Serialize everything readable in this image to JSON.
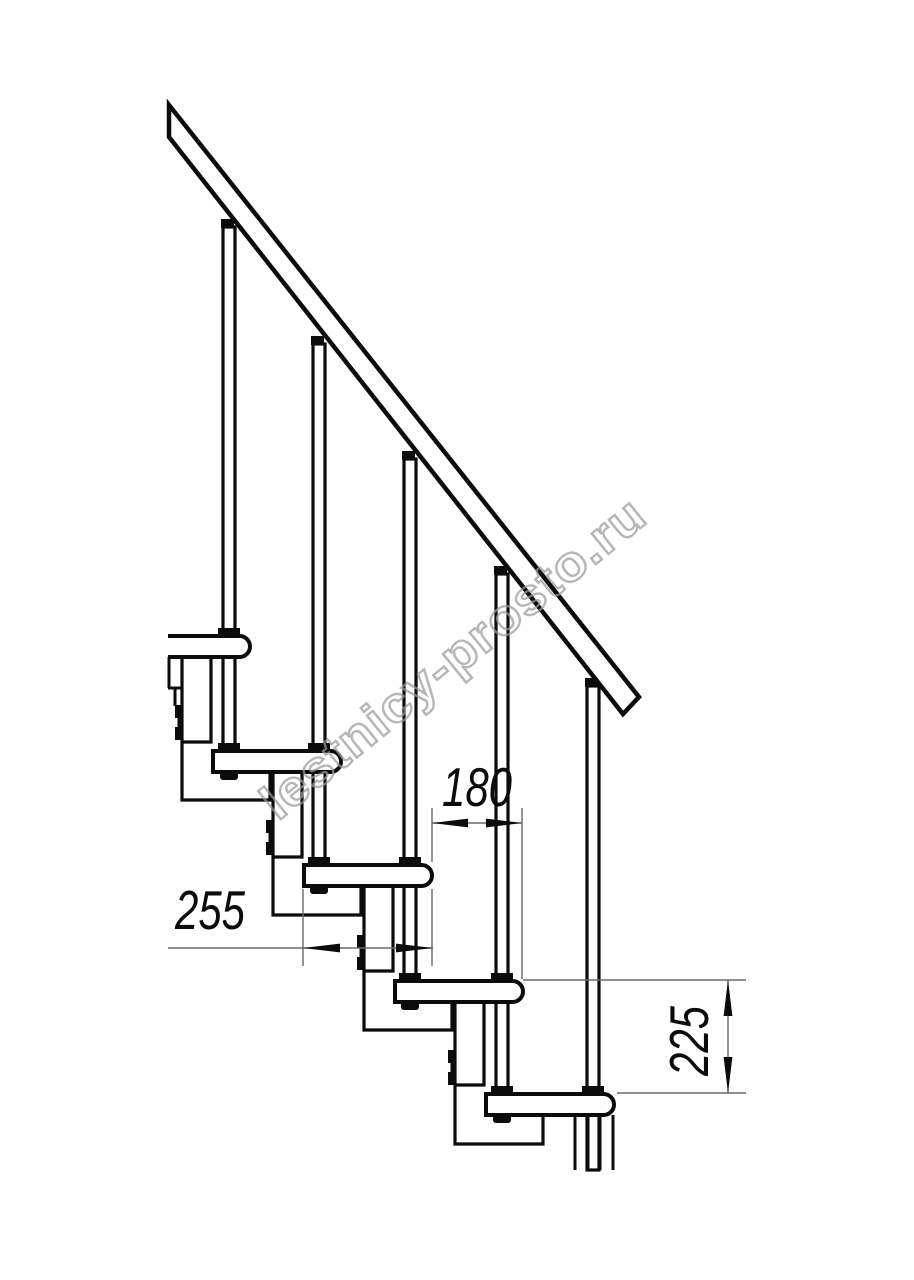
{
  "title": "Modular staircase side-view technical drawing",
  "colors": {
    "paper": "#ffffff",
    "ink": "#0b0b0b",
    "dim_line": "#6a6a6a",
    "watermark": "#9a9a9a"
  },
  "dimensions": {
    "step_run": "180",
    "tread_depth": "255",
    "riser_height": "225"
  },
  "watermark": {
    "text": "lestnicy-prosto.ru"
  }
}
